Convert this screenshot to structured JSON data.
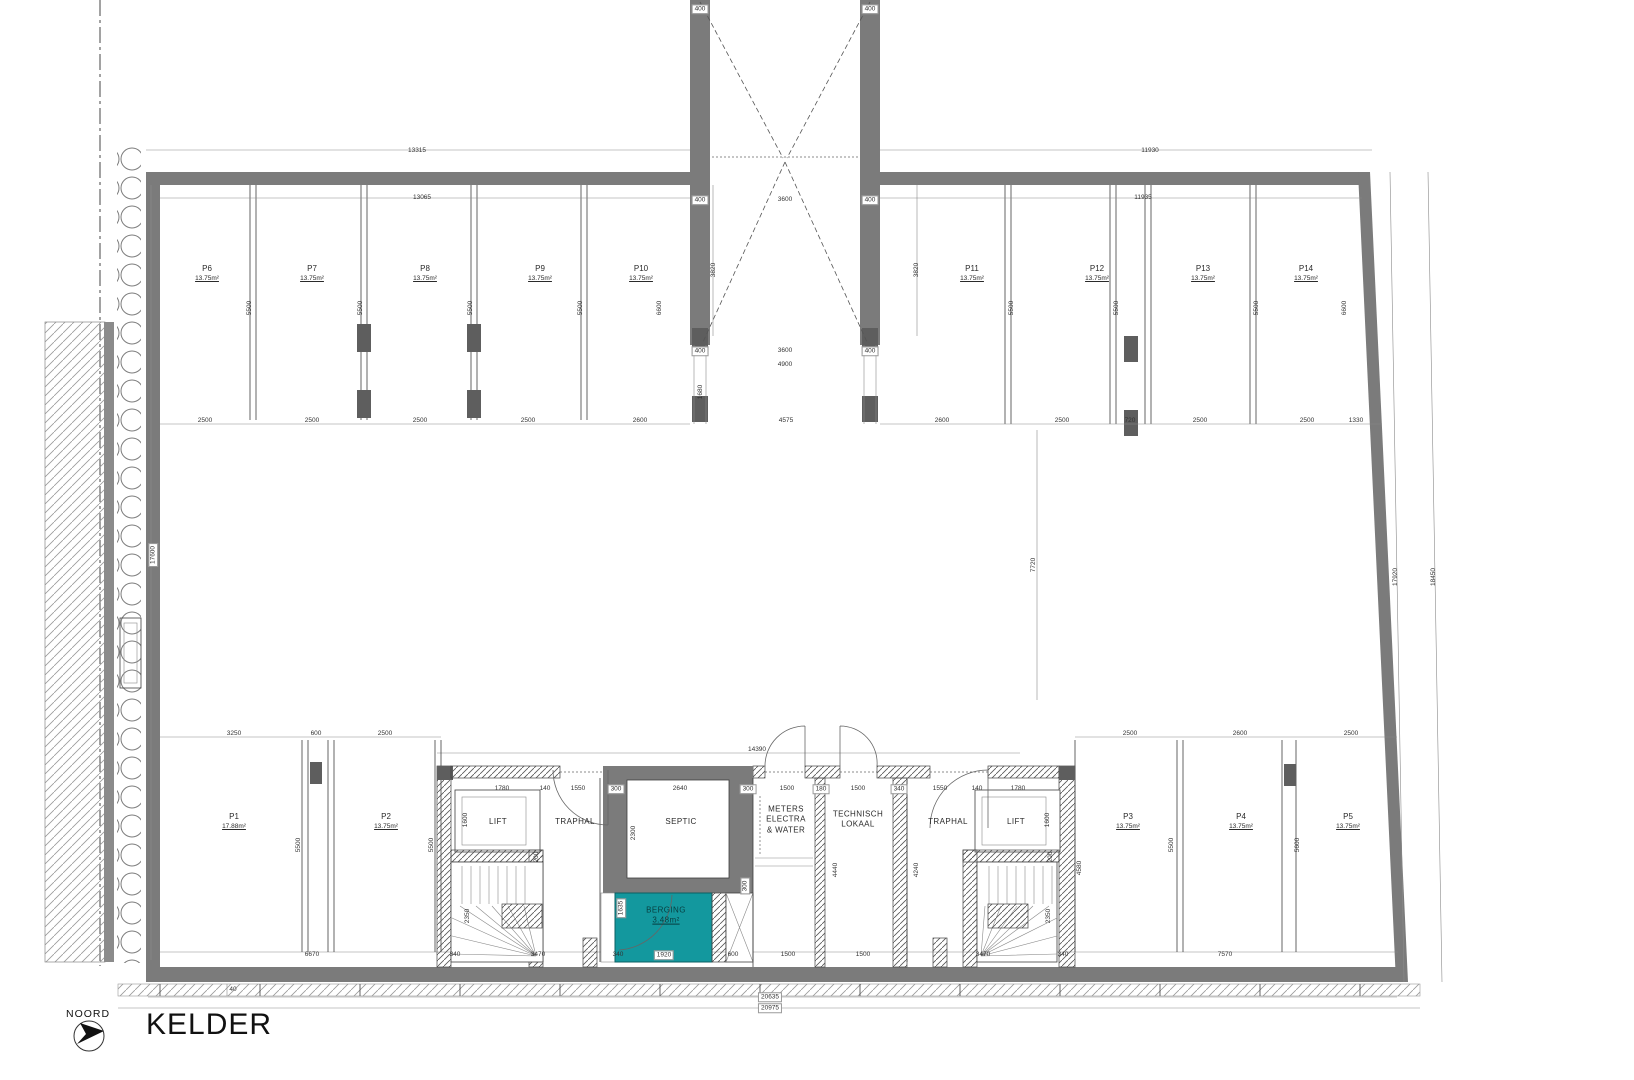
{
  "titleblock": {
    "north_label": "NOORD",
    "title": "KELDER"
  },
  "colors": {
    "wall": "#7b7b7b",
    "wall_dark": "#5e5e5e",
    "teal": "#13989e",
    "line": "#3f3f3f",
    "hatch": "#555555",
    "dim_text": "#333333"
  },
  "parking": [
    {
      "id": "P1",
      "area": "17.88m²",
      "x": 234,
      "y": 812
    },
    {
      "id": "P2",
      "area": "13.75m²",
      "x": 386,
      "y": 812
    },
    {
      "id": "P3",
      "area": "13.75m²",
      "x": 1128,
      "y": 812
    },
    {
      "id": "P4",
      "area": "13.75m²",
      "x": 1241,
      "y": 812
    },
    {
      "id": "P5",
      "area": "13.75m²",
      "x": 1348,
      "y": 812
    },
    {
      "id": "P6",
      "area": "13.75m²",
      "x": 207,
      "y": 264
    },
    {
      "id": "P7",
      "area": "13.75m²",
      "x": 312,
      "y": 264
    },
    {
      "id": "P8",
      "area": "13.75m²",
      "x": 425,
      "y": 264
    },
    {
      "id": "P9",
      "area": "13.75m²",
      "x": 540,
      "y": 264
    },
    {
      "id": "P10",
      "area": "13.75m²",
      "x": 641,
      "y": 264
    },
    {
      "id": "P11",
      "area": "13.75m²",
      "x": 972,
      "y": 264
    },
    {
      "id": "P12",
      "area": "13.75m²",
      "x": 1097,
      "y": 264
    },
    {
      "id": "P13",
      "area": "13.75m²",
      "x": 1203,
      "y": 264
    },
    {
      "id": "P14",
      "area": "13.75m²",
      "x": 1306,
      "y": 264
    }
  ],
  "rooms": [
    {
      "name": "lift-left",
      "lines": [
        "LIFT"
      ],
      "x": 498,
      "y": 822
    },
    {
      "name": "traphal-left",
      "lines": [
        "TRAPHAL"
      ],
      "x": 575,
      "y": 822
    },
    {
      "name": "septic",
      "lines": [
        "SEPTIC"
      ],
      "x": 681,
      "y": 822
    },
    {
      "name": "meters-electra-water",
      "lines": [
        "METERS",
        "ELECTRA",
        "& WATER"
      ],
      "x": 786,
      "y": 820
    },
    {
      "name": "technisch-lokaal",
      "lines": [
        "TECHNISCH",
        "LOKAAL"
      ],
      "x": 858,
      "y": 820
    },
    {
      "name": "traphal-right",
      "lines": [
        "TRAPHAL"
      ],
      "x": 948,
      "y": 822
    },
    {
      "name": "lift-right",
      "lines": [
        "LIFT"
      ],
      "x": 1016,
      "y": 822
    },
    {
      "name": "berging",
      "lines": [
        "BERGING",
        "3.48m²"
      ],
      "u": 1,
      "x": 666,
      "y": 916,
      "cls": "berging"
    }
  ],
  "dim_labels": [
    {
      "t": "13315",
      "x": 417,
      "y": 151
    },
    {
      "t": "11930",
      "x": 1150,
      "y": 151
    },
    {
      "t": "13065",
      "x": 422,
      "y": 198
    },
    {
      "t": "11935",
      "x": 1143,
      "y": 198
    },
    {
      "t": "400",
      "x": 700,
      "y": 9,
      "b": 1
    },
    {
      "t": "400",
      "x": 870,
      "y": 9,
      "b": 1
    },
    {
      "t": "400",
      "x": 700,
      "y": 200,
      "b": 1
    },
    {
      "t": "3600",
      "x": 785,
      "y": 200
    },
    {
      "t": "400",
      "x": 870,
      "y": 200,
      "b": 1
    },
    {
      "t": "3820",
      "x": 714,
      "y": 270,
      "r": 1
    },
    {
      "t": "3820",
      "x": 917,
      "y": 270,
      "r": 1
    },
    {
      "t": "5500",
      "x": 250,
      "y": 308,
      "r": 1
    },
    {
      "t": "5500",
      "x": 361,
      "y": 308,
      "r": 1
    },
    {
      "t": "5500",
      "x": 471,
      "y": 308,
      "r": 1
    },
    {
      "t": "5500",
      "x": 581,
      "y": 308,
      "r": 1
    },
    {
      "t": "6600",
      "x": 660,
      "y": 308,
      "r": 1
    },
    {
      "t": "5500",
      "x": 1012,
      "y": 308,
      "r": 1
    },
    {
      "t": "5500",
      "x": 1117,
      "y": 308,
      "r": 1
    },
    {
      "t": "5500",
      "x": 1257,
      "y": 308,
      "r": 1
    },
    {
      "t": "6600",
      "x": 1345,
      "y": 308,
      "r": 1
    },
    {
      "t": "400",
      "x": 700,
      "y": 351,
      "b": 1
    },
    {
      "t": "3600",
      "x": 785,
      "y": 351
    },
    {
      "t": "400",
      "x": 870,
      "y": 351,
      "b": 1
    },
    {
      "t": "4900",
      "x": 785,
      "y": 365
    },
    {
      "t": "1680",
      "x": 701,
      "y": 392,
      "r": 1
    },
    {
      "t": "2500",
      "x": 205,
      "y": 421
    },
    {
      "t": "2500",
      "x": 312,
      "y": 421
    },
    {
      "t": "2500",
      "x": 420,
      "y": 421
    },
    {
      "t": "2500",
      "x": 528,
      "y": 421
    },
    {
      "t": "2600",
      "x": 640,
      "y": 421
    },
    {
      "t": "4575",
      "x": 786,
      "y": 421
    },
    {
      "t": "2600",
      "x": 942,
      "y": 421
    },
    {
      "t": "2500",
      "x": 1062,
      "y": 421
    },
    {
      "t": "720",
      "x": 1130,
      "y": 421
    },
    {
      "t": "2500",
      "x": 1200,
      "y": 421
    },
    {
      "t": "2500",
      "x": 1307,
      "y": 421
    },
    {
      "t": "1330",
      "x": 1356,
      "y": 421
    },
    {
      "t": "17600",
      "x": 153,
      "y": 555,
      "r": 1,
      "b": 1
    },
    {
      "t": "7720",
      "x": 1034,
      "y": 565,
      "r": 1
    },
    {
      "t": "17920",
      "x": 1396,
      "y": 577,
      "r": 1
    },
    {
      "t": "18450",
      "x": 1434,
      "y": 577,
      "r": 1
    },
    {
      "t": "3250",
      "x": 234,
      "y": 734
    },
    {
      "t": "600",
      "x": 316,
      "y": 734
    },
    {
      "t": "2500",
      "x": 385,
      "y": 734
    },
    {
      "t": "2500",
      "x": 1130,
      "y": 734
    },
    {
      "t": "2600",
      "x": 1240,
      "y": 734
    },
    {
      "t": "2500",
      "x": 1351,
      "y": 734
    },
    {
      "t": "14390",
      "x": 757,
      "y": 750
    },
    {
      "t": "1780",
      "x": 502,
      "y": 789
    },
    {
      "t": "140",
      "x": 545,
      "y": 789
    },
    {
      "t": "1550",
      "x": 578,
      "y": 789
    },
    {
      "t": "300",
      "x": 616,
      "y": 789,
      "b": 1
    },
    {
      "t": "2640",
      "x": 680,
      "y": 789
    },
    {
      "t": "300",
      "x": 748,
      "y": 789,
      "b": 1
    },
    {
      "t": "1500",
      "x": 787,
      "y": 789
    },
    {
      "t": "180",
      "x": 821,
      "y": 789,
      "b": 1
    },
    {
      "t": "1500",
      "x": 858,
      "y": 789
    },
    {
      "t": "340",
      "x": 899,
      "y": 789,
      "b": 1
    },
    {
      "t": "1550",
      "x": 940,
      "y": 789
    },
    {
      "t": "140",
      "x": 977,
      "y": 789
    },
    {
      "t": "1780",
      "x": 1018,
      "y": 789
    },
    {
      "t": "1600",
      "x": 466,
      "y": 820,
      "r": 1
    },
    {
      "t": "2300",
      "x": 634,
      "y": 833,
      "r": 1
    },
    {
      "t": "1600",
      "x": 1048,
      "y": 820,
      "r": 1
    },
    {
      "t": "200",
      "x": 537,
      "y": 857,
      "r": 1
    },
    {
      "t": "200",
      "x": 1051,
      "y": 857,
      "r": 1
    },
    {
      "t": "5500",
      "x": 299,
      "y": 845,
      "r": 1
    },
    {
      "t": "5500",
      "x": 432,
      "y": 845,
      "r": 1
    },
    {
      "t": "5500",
      "x": 1172,
      "y": 845,
      "r": 1
    },
    {
      "t": "5600",
      "x": 1298,
      "y": 845,
      "r": 1
    },
    {
      "t": "4440",
      "x": 836,
      "y": 870,
      "r": 1
    },
    {
      "t": "4240",
      "x": 917,
      "y": 870,
      "r": 1
    },
    {
      "t": "4580",
      "x": 1080,
      "y": 868,
      "r": 1
    },
    {
      "t": "1635",
      "x": 621,
      "y": 908,
      "r": 1,
      "b": 1
    },
    {
      "t": "300",
      "x": 745,
      "y": 886,
      "r": 1,
      "b": 1
    },
    {
      "t": "2350",
      "x": 468,
      "y": 916,
      "r": 1
    },
    {
      "t": "2350",
      "x": 1049,
      "y": 916,
      "r": 1
    },
    {
      "t": "6670",
      "x": 312,
      "y": 955
    },
    {
      "t": "340",
      "x": 455,
      "y": 955
    },
    {
      "t": "3470",
      "x": 538,
      "y": 955
    },
    {
      "t": "340",
      "x": 618,
      "y": 955
    },
    {
      "t": "1920",
      "x": 664,
      "y": 955,
      "b": 1
    },
    {
      "t": "600",
      "x": 733,
      "y": 955
    },
    {
      "t": "1500",
      "x": 788,
      "y": 955
    },
    {
      "t": "1500",
      "x": 863,
      "y": 955
    },
    {
      "t": "3470",
      "x": 983,
      "y": 955
    },
    {
      "t": "340",
      "x": 1063,
      "y": 955
    },
    {
      "t": "7570",
      "x": 1225,
      "y": 955
    },
    {
      "t": "40",
      "x": 233,
      "y": 990
    },
    {
      "t": "20635",
      "x": 770,
      "y": 997,
      "b": 1
    },
    {
      "t": "20975",
      "x": 770,
      "y": 1008,
      "b": 1
    }
  ]
}
